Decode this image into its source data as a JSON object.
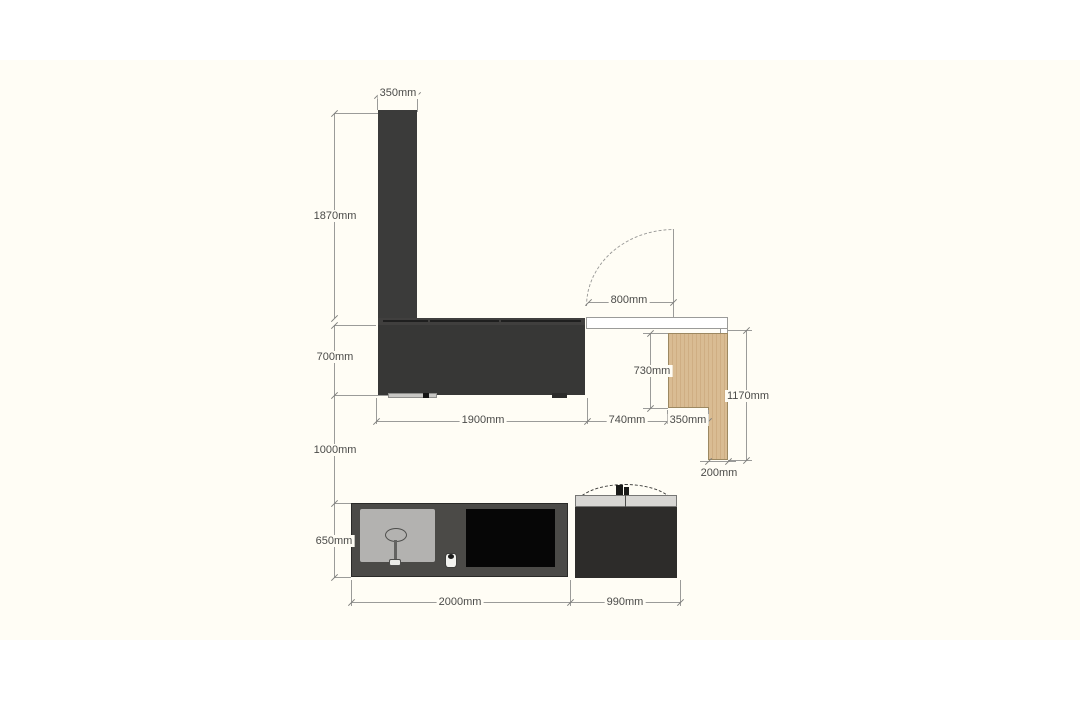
{
  "meta": {
    "drawing_type": "furniture dimension diagram",
    "unit": "mm"
  },
  "dims": {
    "column_width": "350mm",
    "column_height": "1870mm",
    "door_clearance": "800mm",
    "counter_height": "700mm",
    "counter_width": "1900mm",
    "gap_width": "740mm",
    "panel_upper_height": "730mm",
    "panel_total_height": "1170mm",
    "panel_width": "350mm",
    "panel_leg_width": "200mm",
    "vertical_gap": "1000mm",
    "island_height": "650mm",
    "island_width": "2000mm",
    "side_unit_width": "990mm"
  },
  "colors": {
    "background": "#ffffff",
    "paper": "#fffdf5",
    "dark_unit": "#3b3b3a",
    "counter_base": "#373736",
    "island_body": "#4b4a47",
    "side_unit_body": "#2d2c2a",
    "side_unit_top": "#d7d6d3",
    "wood_panel": "#d9bc93",
    "cooktop": "#060606",
    "sink_panel": "#b3b2b0",
    "dimension_line": "#9b9b99",
    "dimension_text": "#4b4b49"
  }
}
